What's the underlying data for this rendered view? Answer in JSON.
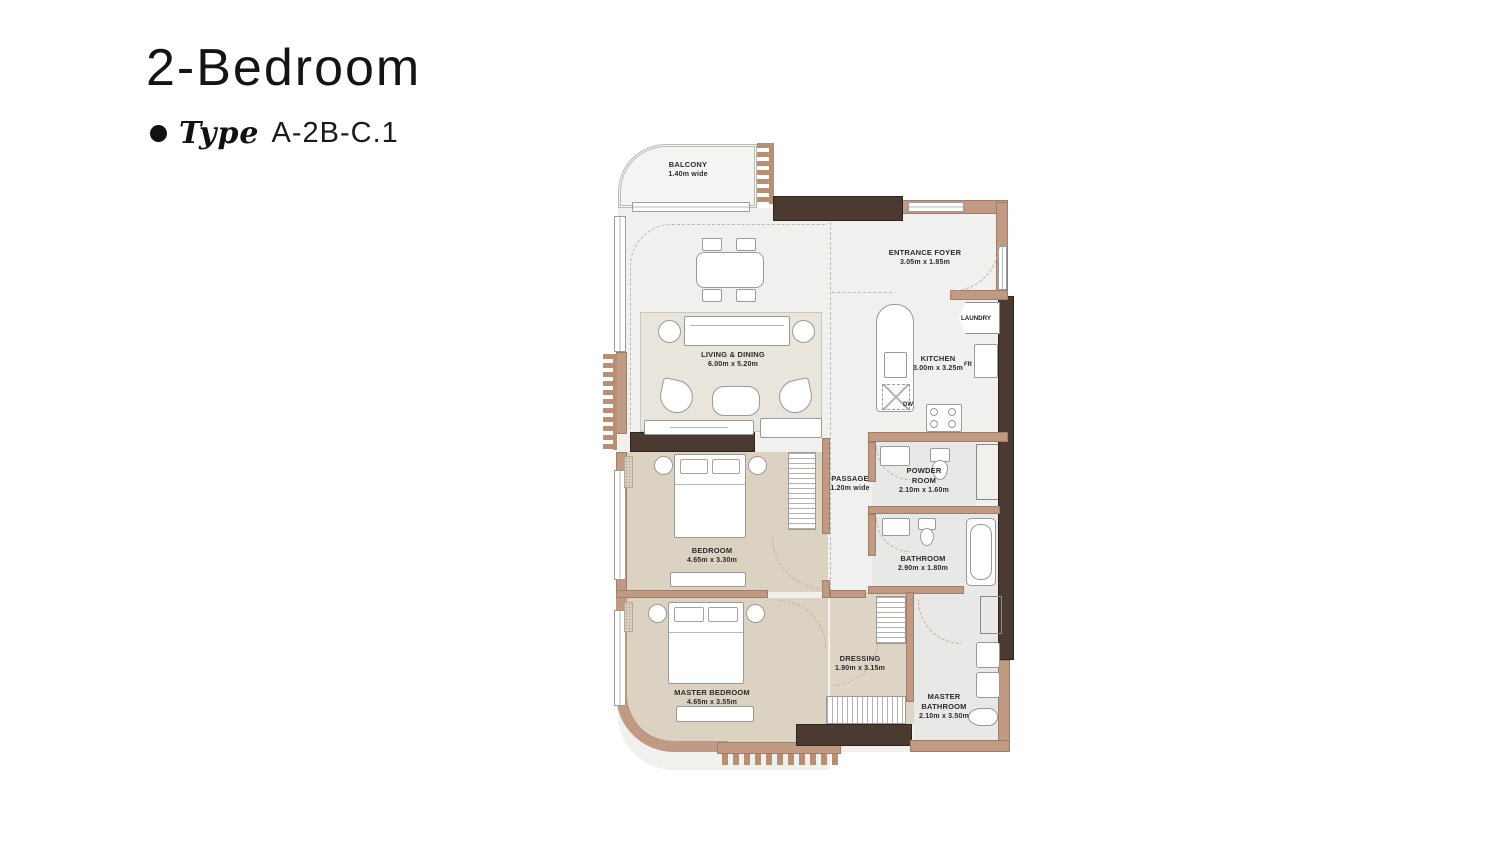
{
  "header": {
    "title": "2-Bedroom",
    "type_label": "Type",
    "type_value": "A-2B-C.1"
  },
  "rooms": {
    "balcony": {
      "name": "BALCONY",
      "dims": "1.40m wide"
    },
    "living_dining": {
      "name": "LIVING & DINING",
      "dims": "6.00m x 5.20m"
    },
    "entrance_foyer": {
      "name": "ENTRANCE FOYER",
      "dims": "3.05m x 1.85m"
    },
    "kitchen": {
      "name": "KITCHEN",
      "dims": "3.00m x 3.25m"
    },
    "laundry": {
      "name": "LAUNDRY"
    },
    "passage": {
      "name": "PASSAGE",
      "dims": "1.20m wide"
    },
    "powder_room": {
      "name": "POWDER ROOM",
      "dims": "2.10m x 1.60m"
    },
    "bathroom": {
      "name": "BATHROOM",
      "dims": "2.90m x 1.80m"
    },
    "bedroom": {
      "name": "BEDROOM",
      "dims": "4.65m x 3.30m"
    },
    "master_bedroom": {
      "name": "MASTER BEDROOM",
      "dims": "4.65m x 3.55m"
    },
    "dressing": {
      "name": "DRESSING",
      "dims": "1.90m x 3.15m"
    },
    "master_bathroom": {
      "name": "MASTER BATHROOM",
      "dims": "2.10m x 3.50m"
    }
  },
  "appliances": {
    "fridge": "FR",
    "dishwasher": "DW"
  },
  "colors": {
    "wall": "#c19a83",
    "wall_dark": "#4a3a31",
    "floor": "#f0f0ee",
    "bedroom_floor": "#dcd2c2",
    "rug": "#e9e4dc",
    "wet_floor": "#e8e8e6",
    "shaft": "#cbcbc9",
    "accent_teeth": "#b98f74"
  }
}
